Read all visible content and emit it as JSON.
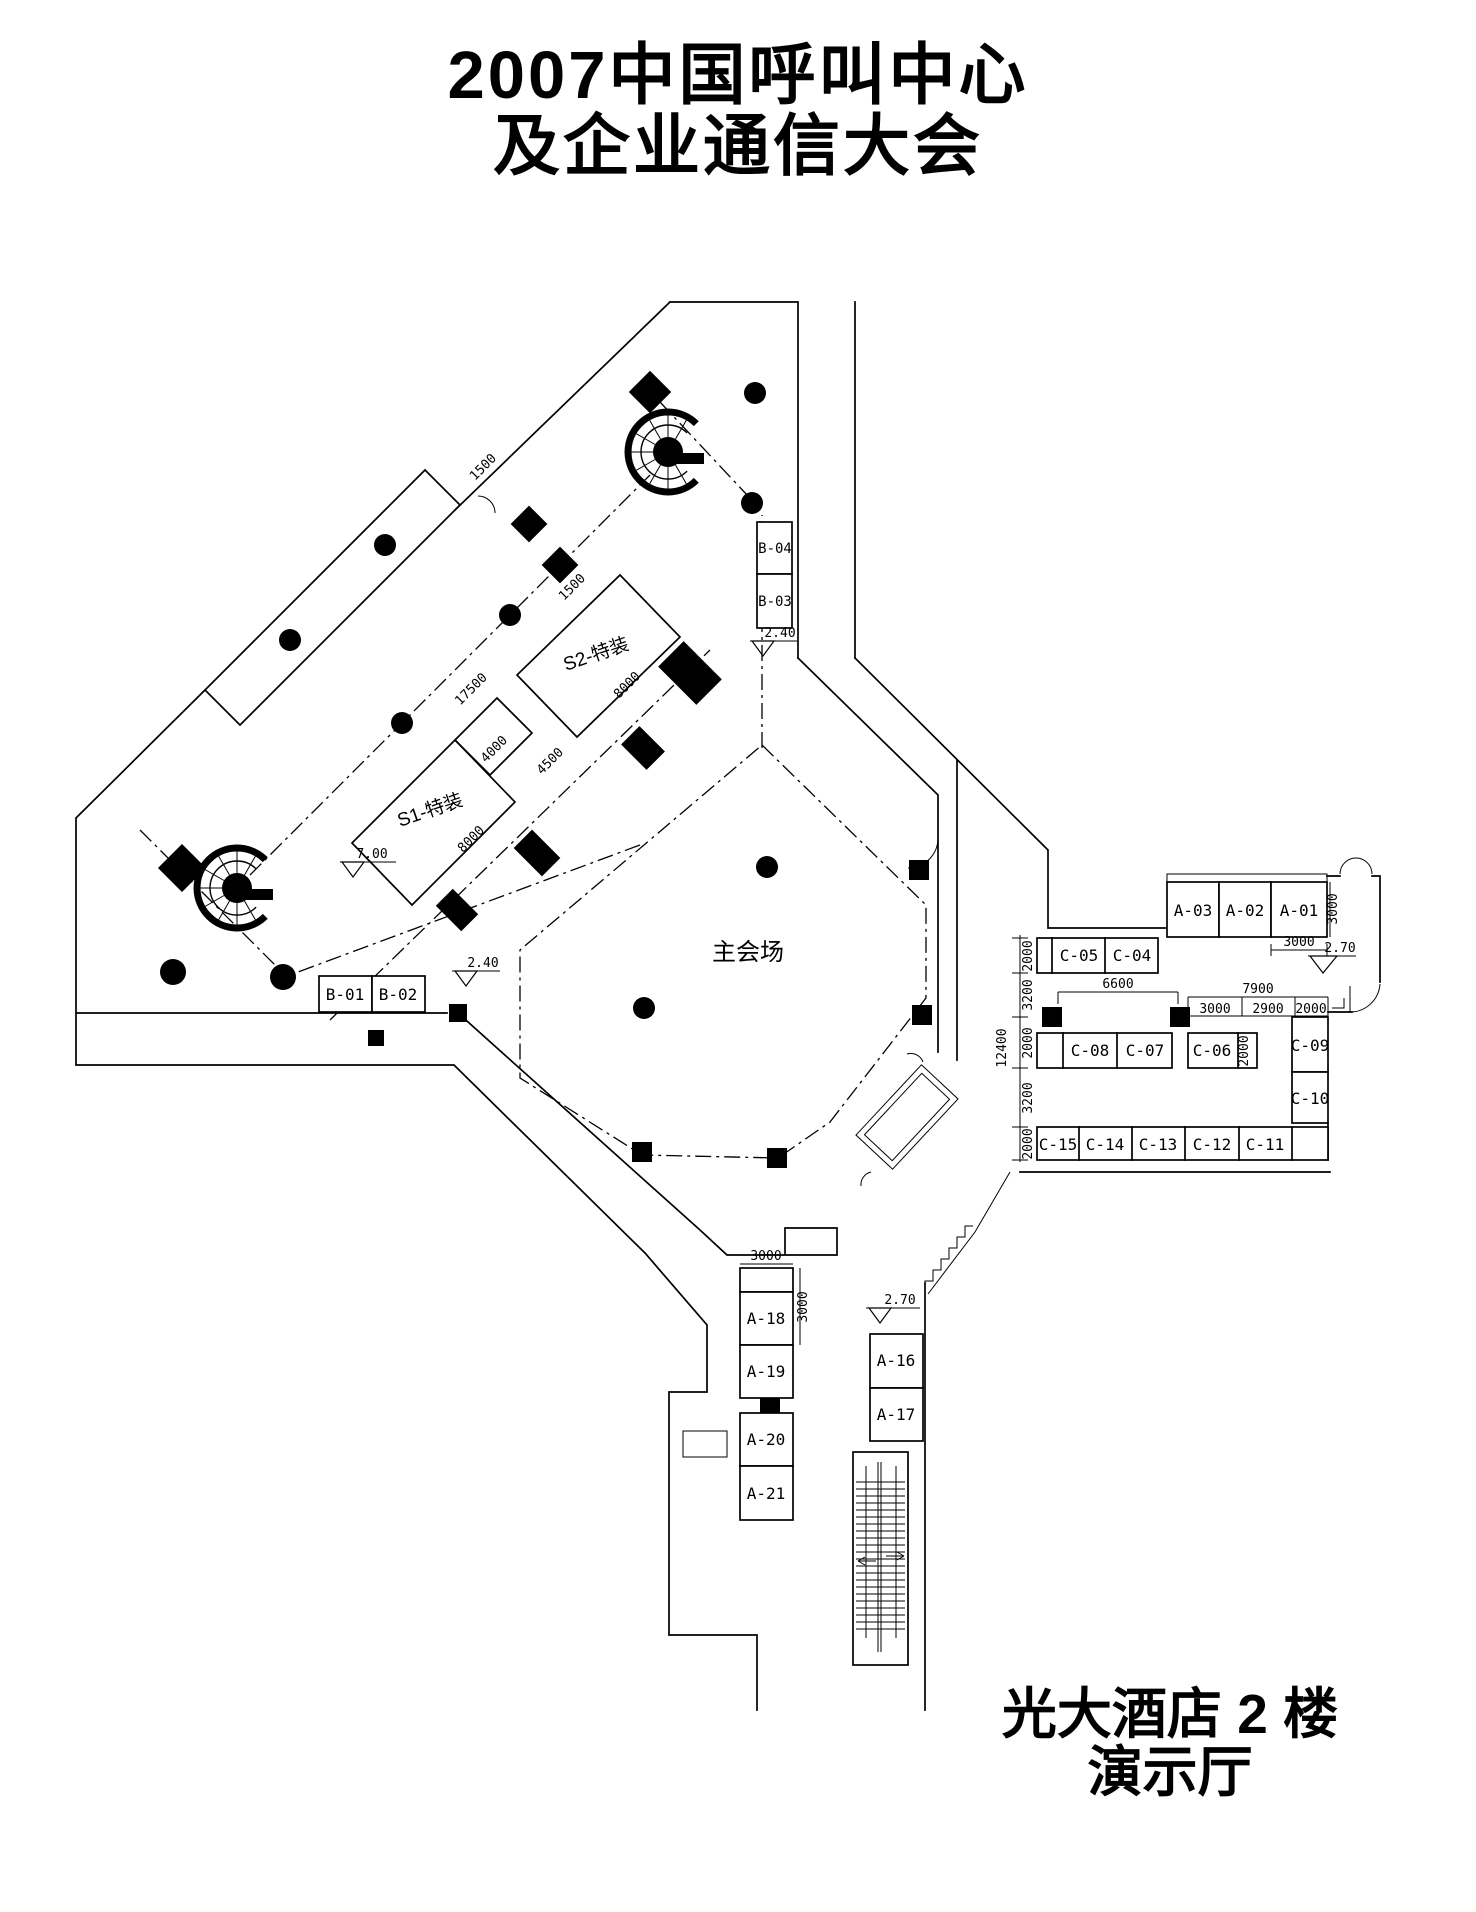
{
  "title": {
    "line1": "2007中国呼叫中心",
    "line2": "及企业通信大会"
  },
  "caption": {
    "line1": "光大酒店 2 楼",
    "line2": "演示厅"
  },
  "areas": {
    "main_hall": "主会场",
    "s1": "S1-特装",
    "s2": "S2-特装"
  },
  "booths": {
    "a01": "A-01",
    "a02": "A-02",
    "a03": "A-03",
    "a16": "A-16",
    "a17": "A-17",
    "a18": "A-18",
    "a19": "A-19",
    "a20": "A-20",
    "a21": "A-21",
    "b01": "B-01",
    "b02": "B-02",
    "b03": "B-03",
    "b04": "B-04",
    "c04": "C-04",
    "c05": "C-05",
    "c06": "C-06",
    "c07": "C-07",
    "c08": "C-08",
    "c09": "C-09",
    "c10": "C-10",
    "c11": "C-11",
    "c12": "C-12",
    "c13": "C-13",
    "c14": "C-14",
    "c15": "C-15"
  },
  "levels": {
    "l700": "7.00",
    "l240": "2.40",
    "l270": "2.70"
  },
  "dims": {
    "d1500": "1500",
    "d17500": "17500",
    "d4000": "4000",
    "d4500": "4500",
    "d8000": "8000",
    "d3000": "3000",
    "d2000": "2000",
    "d3200": "3200",
    "d12400": "12400",
    "d6600": "6600",
    "d7900": "7900",
    "d2900": "2900"
  },
  "colors": {
    "ink": "#000000",
    "paper": "#ffffff"
  }
}
